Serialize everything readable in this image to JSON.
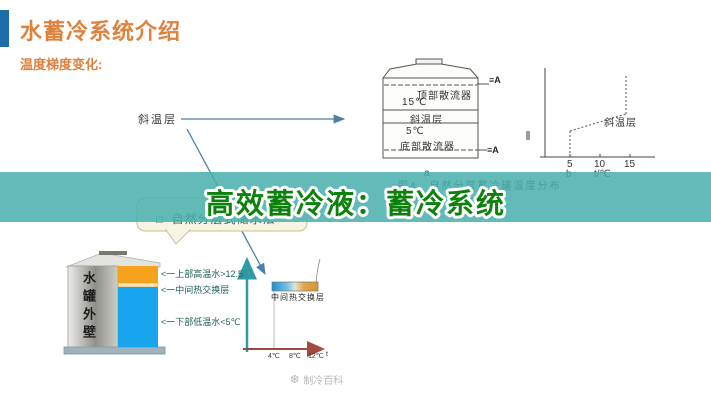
{
  "slide": {
    "title": "水蓄冷系统介绍",
    "subtitle": "温度梯度变化:",
    "overlay_title": "高效蓄冷液：蓄冷系统",
    "colors": {
      "accent_blue": "#1f6da8",
      "title_orange": "#e0813c",
      "band_teal": "#46afad",
      "overlay_green": "#0c820c",
      "warm_water_orange": "#f5a21c",
      "cold_water_blue": "#18a5ee"
    }
  },
  "annotation": {
    "thermocline_pointer": "斜温层"
  },
  "tank_diagram": {
    "top_diffuser": "顶部散流器",
    "temp_top": "15℃",
    "thermocline": "斜温层",
    "temp_bottom": "5℃",
    "bottom_diffuser": "底部散流器",
    "pipe_top": "≡A",
    "pipe_bottom": "≡A",
    "sub_label": "a"
  },
  "temp_graph": {
    "ticks": [
      "5",
      "10",
      "15"
    ],
    "sub_label": "b",
    "axis_unit": "t/℃",
    "curve_label": "斜温层"
  },
  "figure_caption": "图4　自然分层蓄冷罐温度分布",
  "callout": {
    "bullet": "□",
    "text": "自然分层式储水法"
  },
  "storage_tank": {
    "wall_label": "水罐外壁",
    "labels": [
      "<一上部高温水>12.5",
      "<一中间热交换层",
      "<一下部低温水<5℃"
    ]
  },
  "gradient_chart": {
    "bar_label": "中间热交换层",
    "ticks": [
      "4℃",
      "8℃",
      "12℃"
    ],
    "axis_end_label": "t"
  },
  "watermark": {
    "icon": "❆",
    "text": "制冷百科"
  },
  "chart_data": {
    "type": "line",
    "title": "自然分层蓄冷罐温度分布",
    "xlabel": "t/℃",
    "x_ticks": [
      5,
      10,
      15
    ],
    "series": [
      {
        "name": "斜温层温度分布",
        "x": [
          5,
          5,
          15,
          15
        ],
        "y_relative_height": [
          0,
          0.3,
          0.55,
          1
        ]
      }
    ],
    "legend_position": "none",
    "grid": false
  }
}
